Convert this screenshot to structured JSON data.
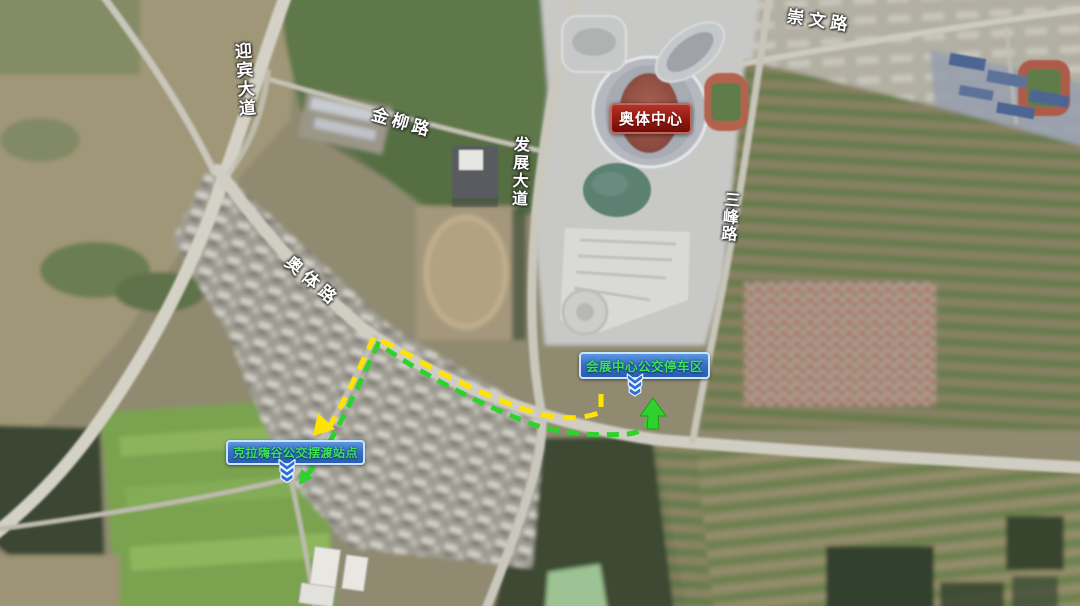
{
  "map": {
    "road_labels": {
      "yingbin": "迎宾大道",
      "jinliu": "金柳路",
      "fazhan": "发展大道",
      "chongwen": "崇文路",
      "sanfeng": "三峰路",
      "aoti": "奥体路"
    },
    "landmark_badge": {
      "label": "奥体中心",
      "bg_color": "#9b1f16",
      "border_color": "#c4655c",
      "text_color": "#ffffff"
    },
    "bus_stop_badges": {
      "huizhan": {
        "label": "会展中心公交停车区"
      },
      "kela": {
        "label": "克拉嗨谷公交摆渡站点"
      },
      "style": {
        "bg_color": "#2f63b6",
        "border_color": "#c8e4ff",
        "text_color": "#3fe257"
      }
    },
    "routes": {
      "yellow": {
        "color": "#ffe400"
      },
      "green": {
        "color": "#2fd12f"
      }
    },
    "icons": {
      "stop_marker": "chevron-down-triple-icon"
    }
  }
}
